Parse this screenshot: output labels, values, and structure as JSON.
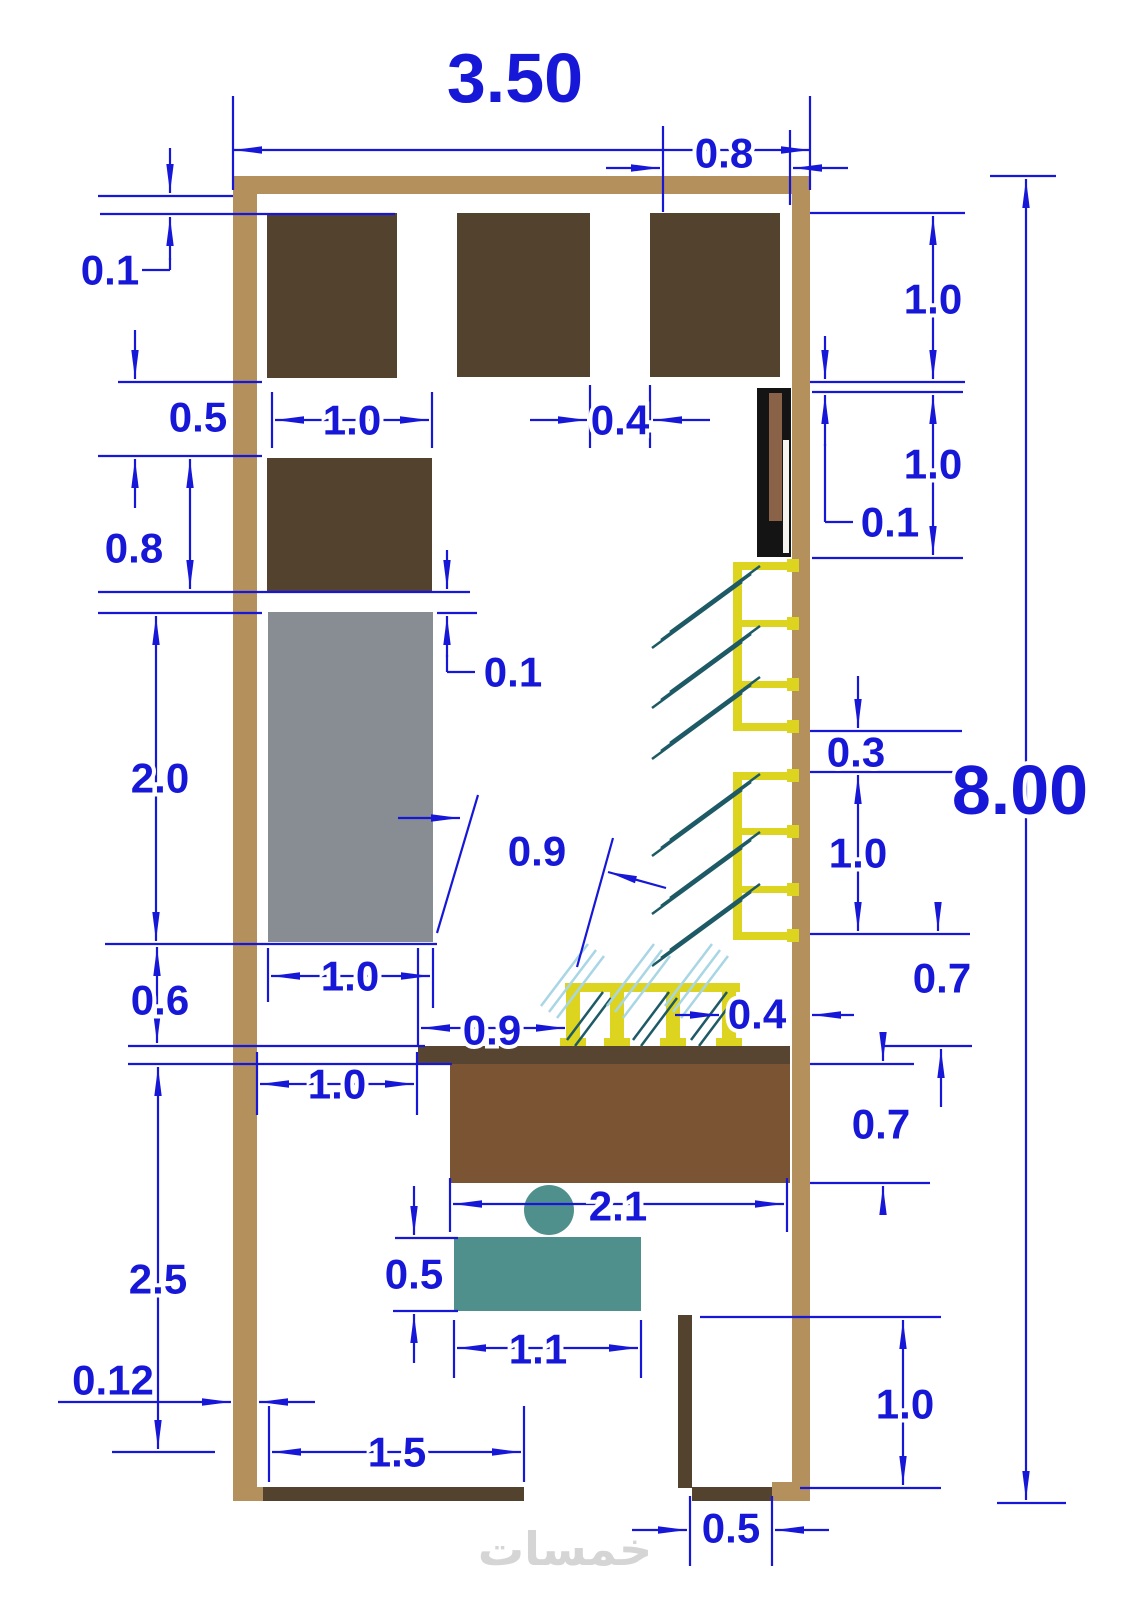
{
  "page": {
    "type": "floor-plan-cad-drawing",
    "watermark": "خمسات"
  },
  "colors": {
    "background": "#FFFFFF",
    "wall": "#B3905C",
    "cabinet_dark": "#53422E",
    "cabinet_gray": "#878D92",
    "counter_top": "#574431",
    "counter_body": "#7B5434",
    "desk_teal": "#4F908C",
    "shelf_yellow": "#DCD41E",
    "fixture_black": "#141414",
    "fixture_brown": "#8A6248",
    "fixture_white": "#F5F3EE",
    "glass_dark": "#1E5A66",
    "glass_light": "#A9D6E5",
    "dimension_blue": "#1717D8",
    "watermark_gray": "#D5D5D5"
  },
  "dims": {
    "overall_width": "3.50",
    "overall_height": "8.00",
    "top_recess": "0.8",
    "top_clearance": "0.1",
    "left_gap": "0.5",
    "left_cabinet": "0.8",
    "gray_cabinet_len": "2.0",
    "mid_gap": "0.6",
    "lower_left_len": "2.5",
    "wall_thk": "0.12",
    "block_width": "1.0",
    "block_gap": "0.4",
    "right_block_h": "1.0",
    "door_h": "1.0",
    "door_gap": "0.1",
    "shelf_gap": "0.3",
    "shelf_h": "1.0",
    "gray_clearance": "0.1",
    "aisle": "0.9",
    "gray_width": "1.0",
    "counter_setback": "0.9",
    "stand_gap": "0.4",
    "counter_left": "1.0",
    "counter_len": "2.1",
    "desk_depth": "0.5",
    "desk_len": "1.1",
    "shelf_floor_gap": "0.7",
    "counter_depth": "0.7",
    "entrance_len": "1.5",
    "niche_h": "1.0",
    "niche_w": "0.5"
  }
}
